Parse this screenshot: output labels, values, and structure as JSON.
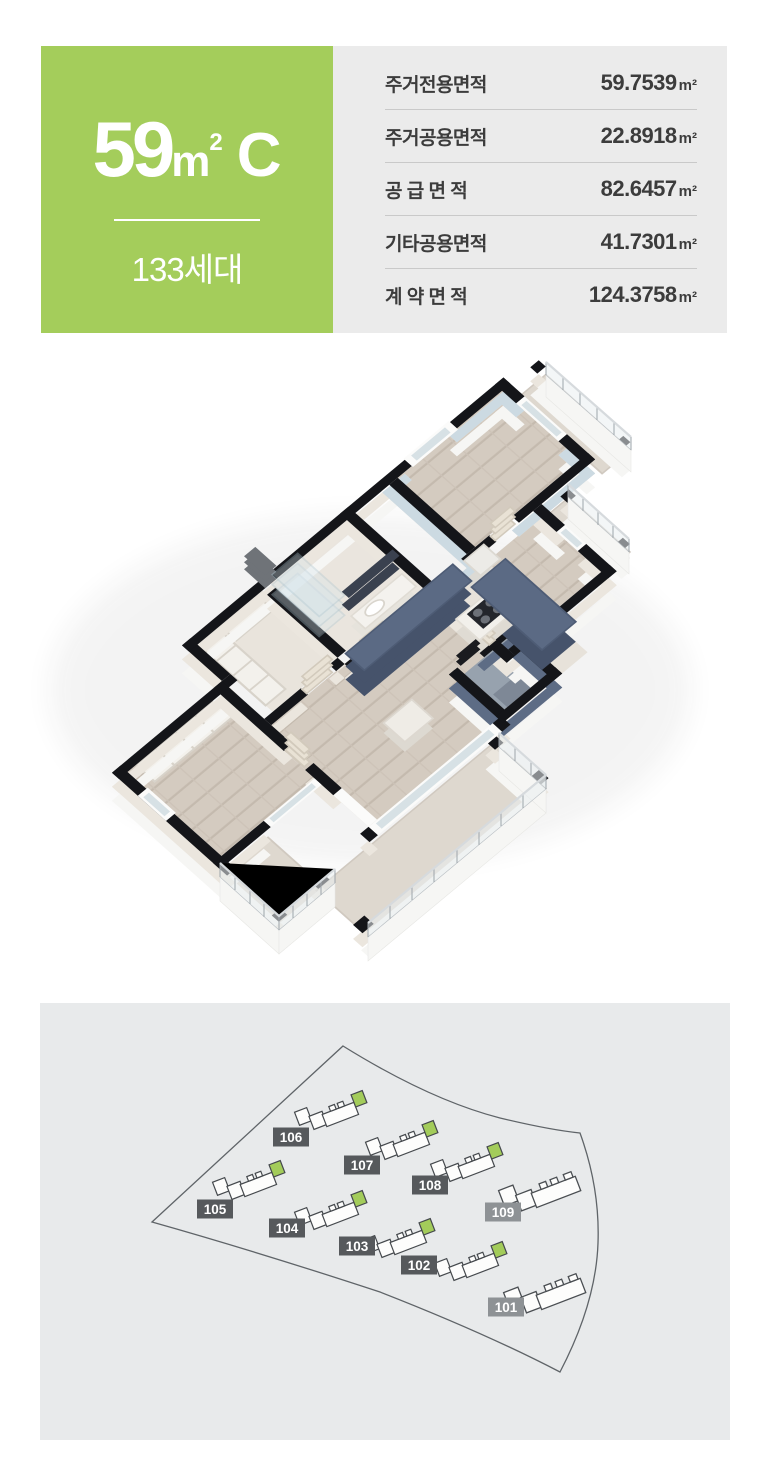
{
  "header": {
    "type_card": {
      "area_number": "59",
      "area_unit": "m",
      "area_unit_sup": "2",
      "type_letter": "C",
      "households": "133세대"
    },
    "area_table": {
      "rows": [
        {
          "label": "주거전용면적",
          "value": "59.7539",
          "unit": "m²"
        },
        {
          "label": "주거공용면적",
          "value": "22.8918",
          "unit": "m²"
        },
        {
          "label": "공 급 면 적",
          "value": "82.6457",
          "unit": "m²"
        },
        {
          "label": "기타공용면적",
          "value": "41.7301",
          "unit": "m²"
        },
        {
          "label": "계 약 면 적",
          "value": "124.3758",
          "unit": "m²"
        }
      ]
    }
  },
  "colors": {
    "accent_green": "#a3cc5a",
    "badge_dark": "#56595c",
    "badge_gray": "#8e9295",
    "table_bg": "#ebebeb",
    "site_bg": "#e8eaeb"
  },
  "site_map": {
    "buildings": [
      {
        "label": "101",
        "badge_color": "#8e9295",
        "has_type": false
      },
      {
        "label": "102",
        "badge_color": "#56595c",
        "has_type": true
      },
      {
        "label": "103",
        "badge_color": "#56595c",
        "has_type": true
      },
      {
        "label": "104",
        "badge_color": "#56595c",
        "has_type": true
      },
      {
        "label": "105",
        "badge_color": "#56595c",
        "has_type": true
      },
      {
        "label": "106",
        "badge_color": "#56595c",
        "has_type": true
      },
      {
        "label": "107",
        "badge_color": "#56595c",
        "has_type": true
      },
      {
        "label": "108",
        "badge_color": "#56595c",
        "has_type": true
      },
      {
        "label": "109",
        "badge_color": "#8e9295",
        "has_type": false
      }
    ]
  }
}
